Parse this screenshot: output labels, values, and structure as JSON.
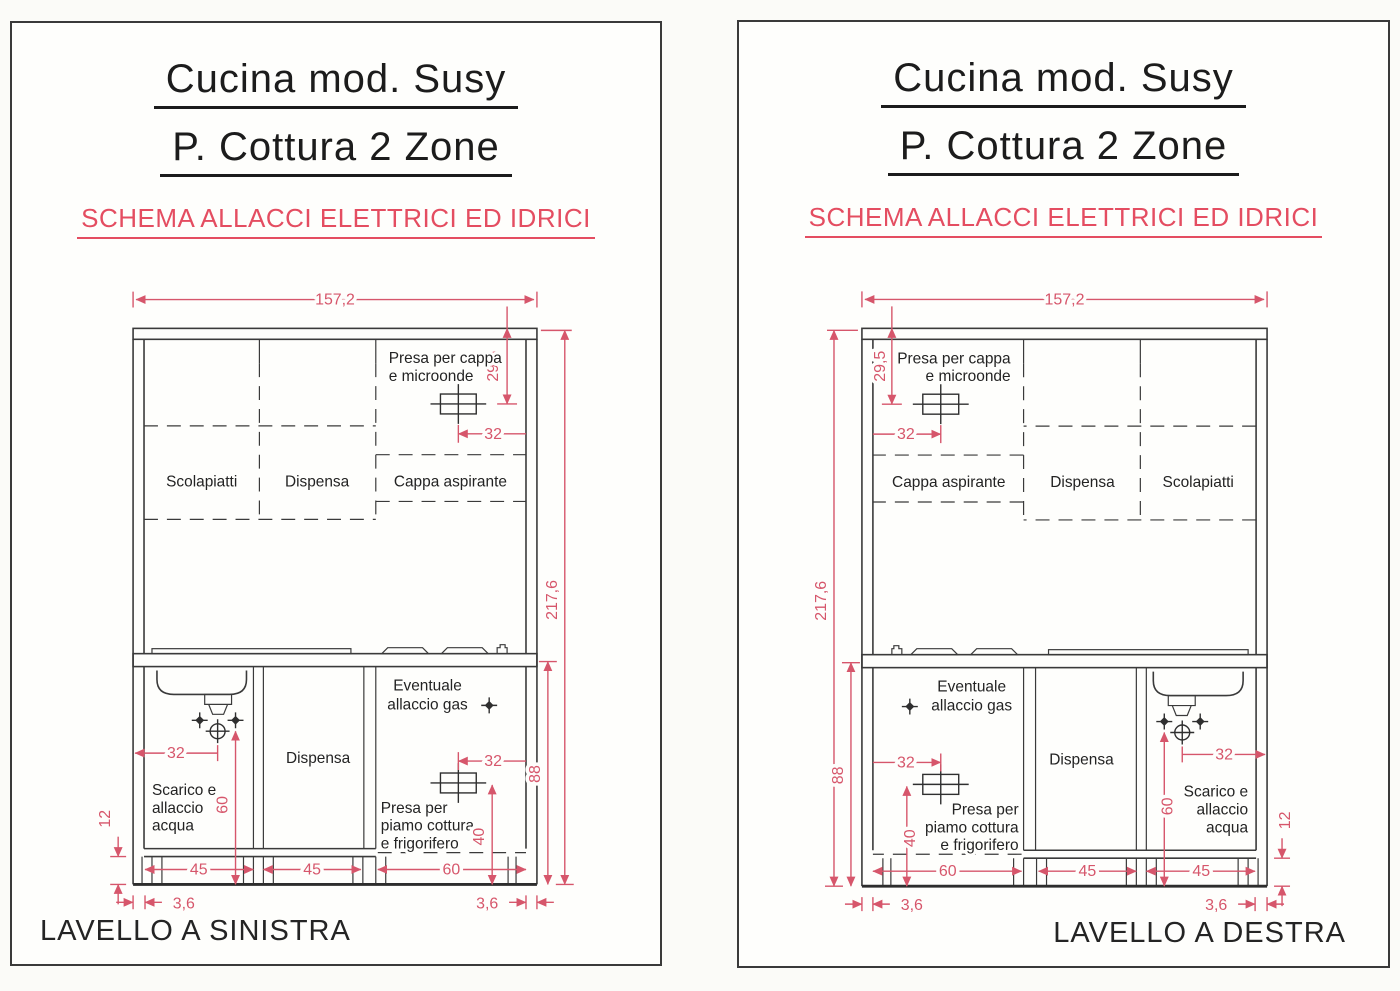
{
  "colors": {
    "dimension_red": "#d6566b",
    "subtitle_red": "#e44d61",
    "ink": "#3a3a3a",
    "paper": "#fefefc"
  },
  "panels": {
    "left": {
      "title_line1": "Cucina mod. Susy",
      "title_line2": "P. Cottura 2 Zone",
      "subtitle": "SCHEMA ALLACCI ELETTRICI ED IDRICI",
      "footer": "LAVELLO A SINISTRA",
      "cabinet_labels": {
        "scolapiatti": "Scolapiatti",
        "dispensa_top": "Dispensa",
        "cappa": "Cappa aspirante",
        "dispensa_bottom": "Dispensa"
      },
      "annotations": {
        "presa_cappa": [
          "Presa per cappa",
          "e microonde"
        ],
        "eventuale_gas": [
          "Eventuale",
          "allaccio gas"
        ],
        "scarico": [
          "Scarico e",
          "allaccio",
          "acqua"
        ],
        "presa_cottura": [
          "Presa per",
          "piamo cottura",
          "e frigorifero"
        ]
      },
      "dims": {
        "total_width": "157,2",
        "hood_socket_drop": "29,5",
        "hood_socket_offset": "32",
        "total_height": "217,6",
        "base_height": "88",
        "sink_drain_offset": "32",
        "drain_height": "60",
        "plinth_height": "12",
        "cooktop_socket_offset": "32",
        "cooktop_socket_height": "40",
        "unit1": "45",
        "unit2": "45",
        "unit3": "60",
        "recess_left": "3,6",
        "recess_right": "3,6"
      }
    },
    "right": {
      "title_line1": "Cucina mod. Susy",
      "title_line2": "P. Cottura 2 Zone",
      "subtitle": "SCHEMA ALLACCI ELETTRICI ED IDRICI",
      "footer": "LAVELLO A DESTRA",
      "cabinet_labels": {
        "scolapiatti": "Scolapiatti",
        "dispensa_top": "Dispensa",
        "cappa": "Cappa aspirante",
        "dispensa_bottom": "Dispensa"
      },
      "annotations": {
        "presa_cappa": [
          "Presa per cappa",
          "e microonde"
        ],
        "eventuale_gas": [
          "Eventuale",
          "allaccio gas"
        ],
        "scarico": [
          "Scarico e",
          "allaccio",
          "acqua"
        ],
        "presa_cottura": [
          "Presa per",
          "piamo cottura",
          "e frigorifero"
        ]
      },
      "dims": {
        "total_width": "157,2",
        "hood_socket_drop": "29,5",
        "hood_socket_offset": "32",
        "total_height": "217,6",
        "base_height": "88",
        "sink_drain_offset": "32",
        "drain_height": "60",
        "plinth_height": "12",
        "cooktop_socket_offset": "32",
        "cooktop_socket_height": "40",
        "unit1": "60",
        "unit2": "45",
        "unit3": "45",
        "recess_left": "3,6",
        "recess_right": "3,6"
      }
    }
  }
}
